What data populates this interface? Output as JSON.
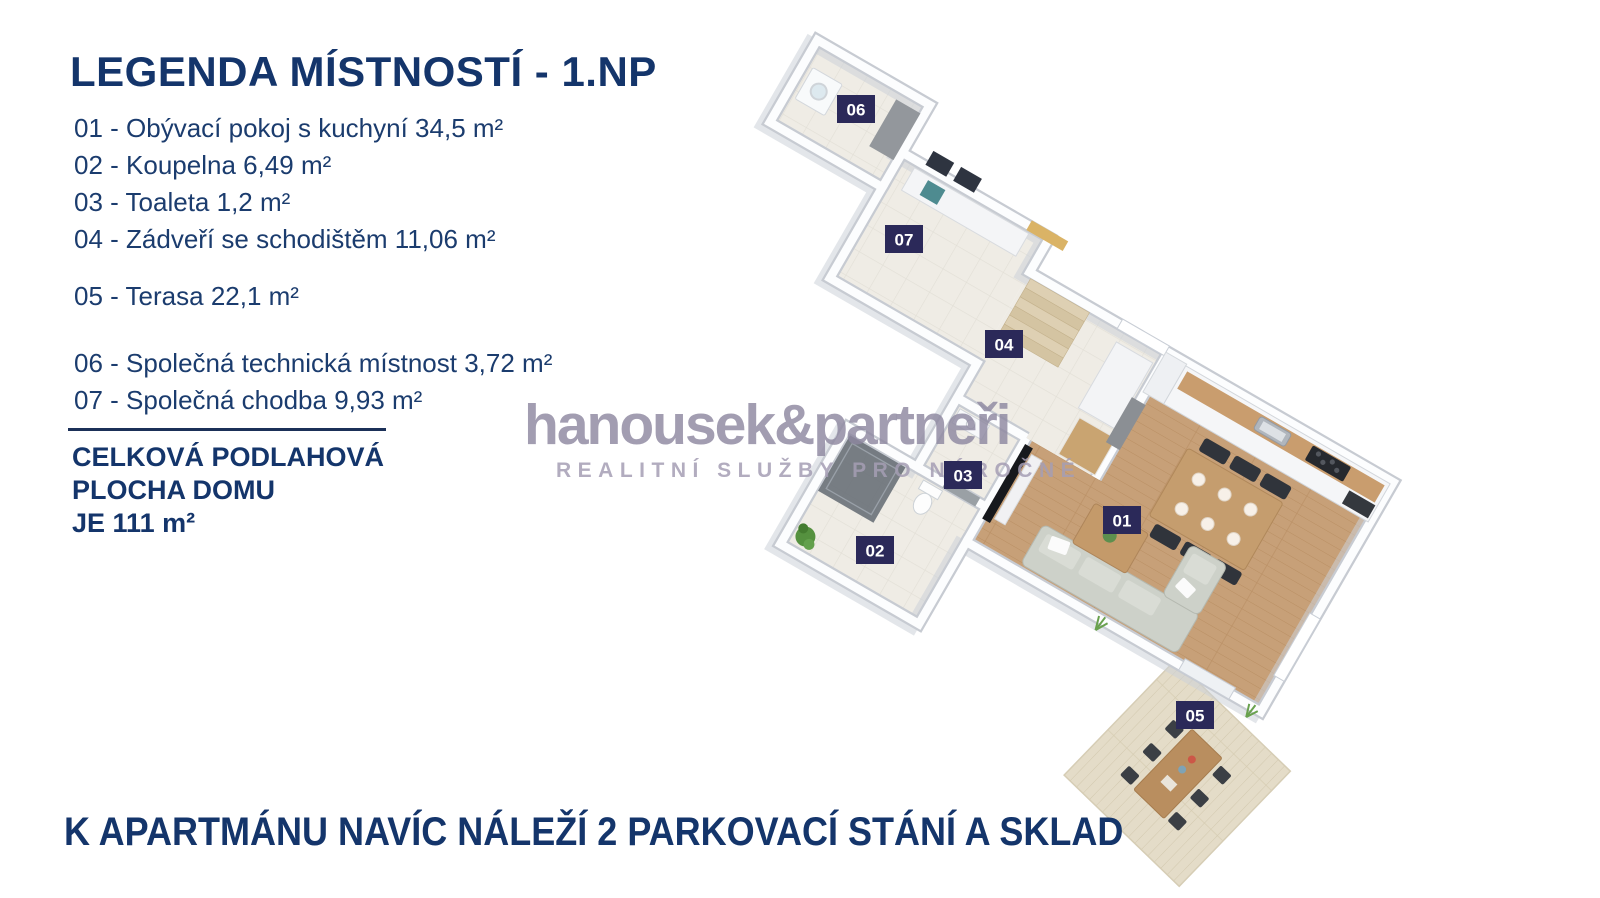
{
  "legend": {
    "title": "LEGENDA MÍSTNOSTÍ - 1.NP",
    "rooms": [
      {
        "line": "01 - Obývací pokoj s kuchyní 34,5 m²"
      },
      {
        "line": "02 - Koupelna 6,49 m²"
      },
      {
        "line": "03 - Toaleta 1,2 m²"
      },
      {
        "line": "04 - Zádveří se schodištěm 11,06 m²"
      },
      {
        "line": "05 - Terasa 22,1 m²"
      },
      {
        "line": "06 - Společná technická místnost 3,72 m²"
      },
      {
        "line": "07 - Společná chodba 9,93 m²"
      }
    ],
    "total_lines": [
      "CELKOVÁ PODLAHOVÁ",
      "PLOCHA DOMU",
      "JE 111 m²"
    ]
  },
  "watermark": {
    "brand": "hanousek&partneři",
    "tagline": "REALITNÍ SLUŽBY PRO NÁROČNÉ"
  },
  "footer": {
    "text": "K APARTMÁNU NAVÍC NÁLEŽÍ 2 PARKOVACÍ STÁNÍ A SKLAD"
  },
  "plan": {
    "room_labels": {
      "r01": "01",
      "r02": "02",
      "r03": "03",
      "r04": "04",
      "r05": "05",
      "r06": "06",
      "r07": "07"
    }
  },
  "colors": {
    "navy_text": "#14356b",
    "chip_navy": "#2b2959",
    "watermark_purple": "#9c95ad",
    "wall_edge": "#c7cbd2",
    "tile_floor": "#efece5",
    "wood_floor": "#c7a078",
    "deck_wood": "#e4dcc8"
  }
}
